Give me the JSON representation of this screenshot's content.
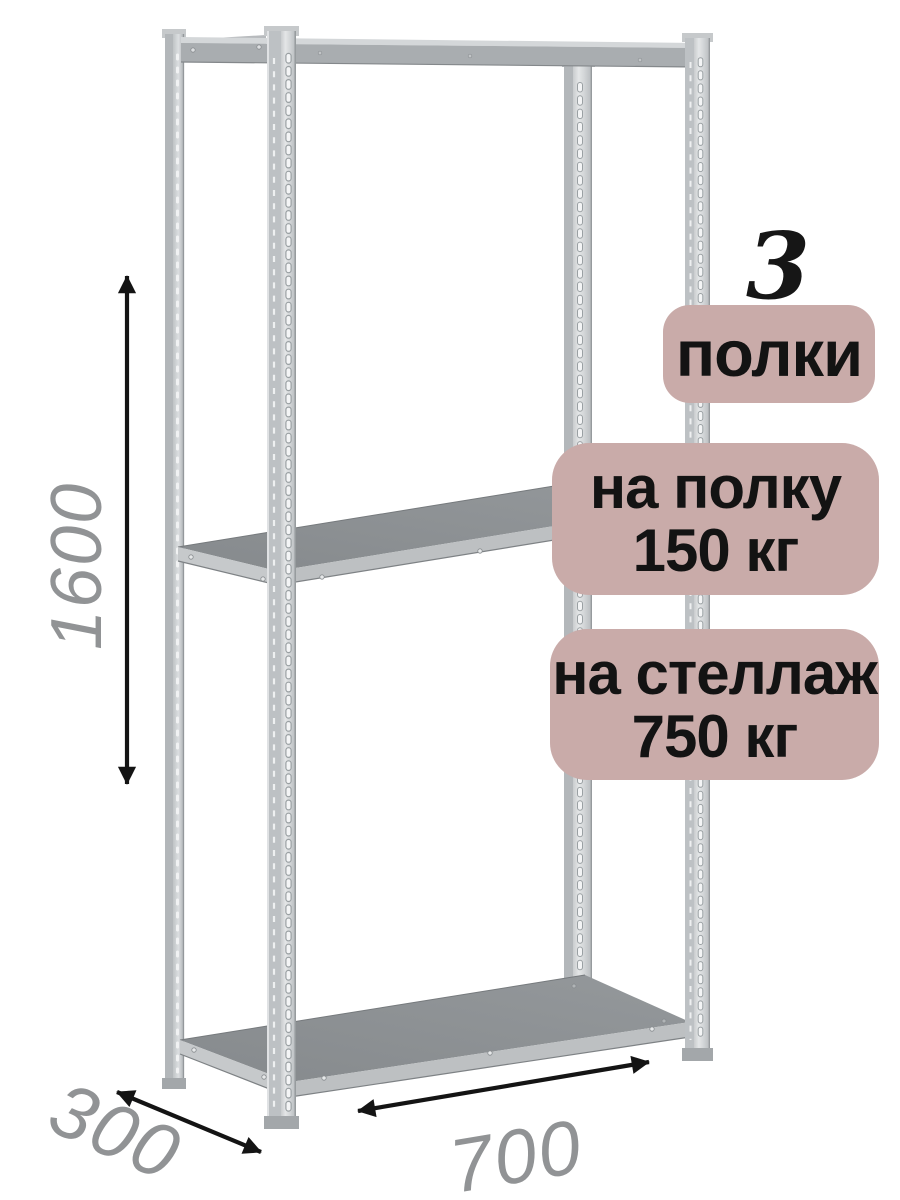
{
  "annotations": {
    "shelf_count": {
      "number": "3",
      "label": "полки"
    },
    "load_per_shelf": {
      "line1": "на полку",
      "line2": "150 кг"
    },
    "load_total": {
      "line1": "на стеллаж",
      "line2": "750 кг"
    }
  },
  "dimensions": {
    "height_mm": "1600",
    "depth_mm": "300",
    "width_mm": "700"
  },
  "colors": {
    "badge_background": "#c9aba9",
    "badge_text": "#131313",
    "dimension_text": "#919395",
    "arrow": "#141414",
    "metal_light": "#d6d9db",
    "metal_mid": "#b3b7ba",
    "shelf_surface": "#8d9194"
  }
}
